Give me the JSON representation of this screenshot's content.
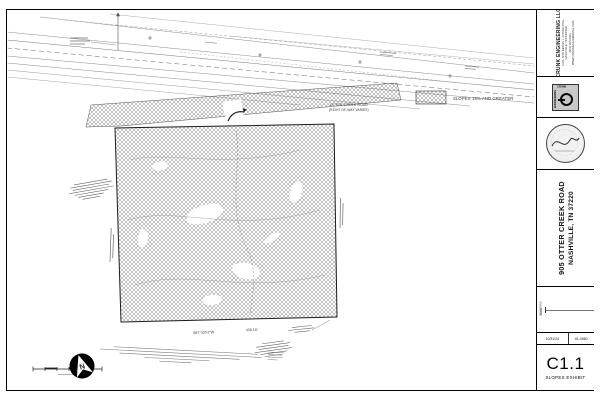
{
  "titleblock": {
    "firm": {
      "name": "CRUNK ENGINEERING LLC",
      "lines": [
        "CIVIL SITE DESIGN + CONSULTING",
        "NASHVILLE, TENNESSEE",
        "(615) 000-0000",
        "WWW.CRUNKENGINEERING.COM"
      ],
      "logo_top": "ENGINEERING",
      "logo_side": "CRUNK"
    },
    "project": {
      "line1": "905 OTTER CREEK ROAD",
      "line2": "NASHVILLE, TN 37220"
    },
    "revisions": {
      "col_label": "REVISIONS",
      "date_label": "DATE",
      "date_value": "10/31/24",
      "job_value": "61-0660"
    },
    "sheet": {
      "number": "C1.1",
      "title": "SLOPES EXHIBIT"
    }
  },
  "legend": {
    "swatch": "crosshatch",
    "label": "SLOPES 15% AND GREATER"
  },
  "drawing": {
    "road_name": "OTTER CREEK ROAD",
    "road_row_note": "(RIGHT-OF-WAY VARIES)",
    "south_bearing": "S87°32'57\"W",
    "south_distance": "430.10'",
    "north_letter": "N"
  }
}
